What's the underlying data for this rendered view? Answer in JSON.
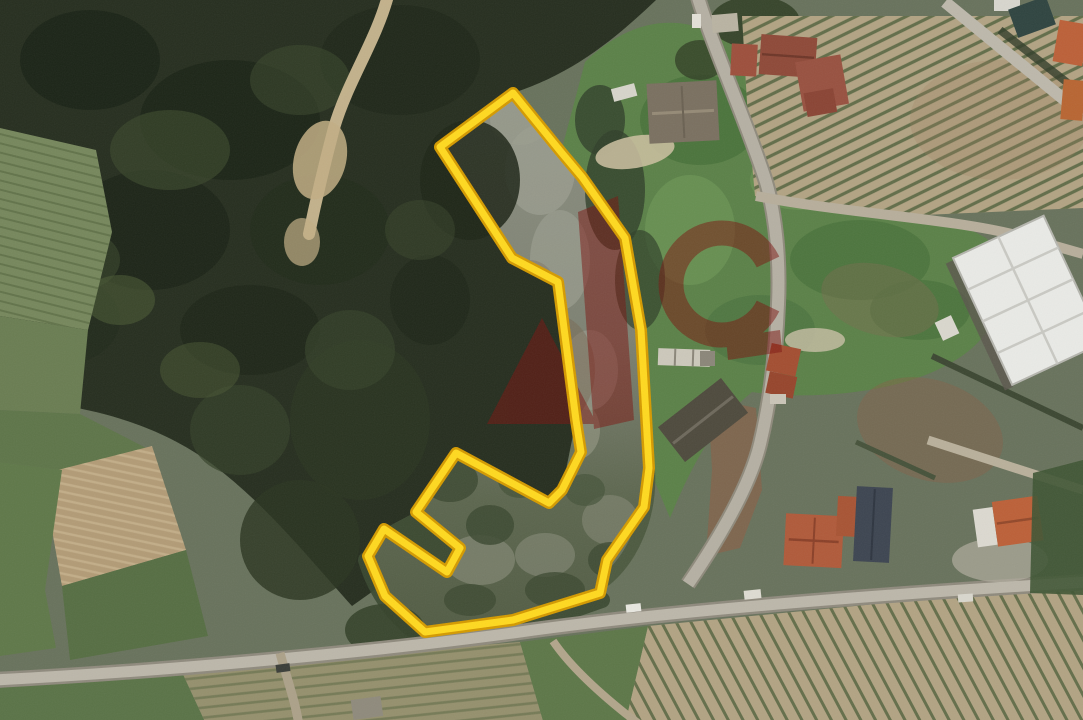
{
  "image": {
    "type": "satellite aerial photograph",
    "subject": "rural land parcel highlighted with a yellow boundary overlay, surrounded by forest, farm fields, vineyards, houses and roads",
    "width_px": 1083,
    "height_px": 720
  },
  "overlay": {
    "parcel_boundary": {
      "points": "513,93 561,152 582,177 625,238 641,330 649,468 644,507 607,560 600,593 513,620 425,632 385,596 368,556 384,529 447,572 460,548 416,512 456,453 549,503 562,490 581,452 576,420 558,282 512,258 440,147",
      "line_color": "#ffd91f",
      "casing_color": "#d49a00"
    },
    "watermark": {
      "color": "#7c1410",
      "opacity": 0.5,
      "shapes": [
        "letter-A-triangle",
        "letter-A-stem",
        "letter-G-ring",
        "letter-G-bar"
      ]
    }
  },
  "terrain": {
    "base": "#68725c",
    "forest": "#262e1f",
    "scrub": "#3c4a31",
    "parcel_grey_top": "#8b8e80",
    "parcel_green_bottom": "#525c44",
    "lawn": "#5b8148",
    "field_green": "#76875c",
    "tilled_tan": "#b29b76",
    "vineyard_tan": "#b2a383",
    "vine_row_green": "#55653f",
    "road": "#b5b0a3",
    "dirt_path": "#cbb891",
    "bare_earth": "#8a5f46",
    "roof_red": "#9d4f3c",
    "roof_dark": "#4e4a3d",
    "roof_orange": "#bc6038",
    "warehouse_roof": "#e9eae6"
  }
}
